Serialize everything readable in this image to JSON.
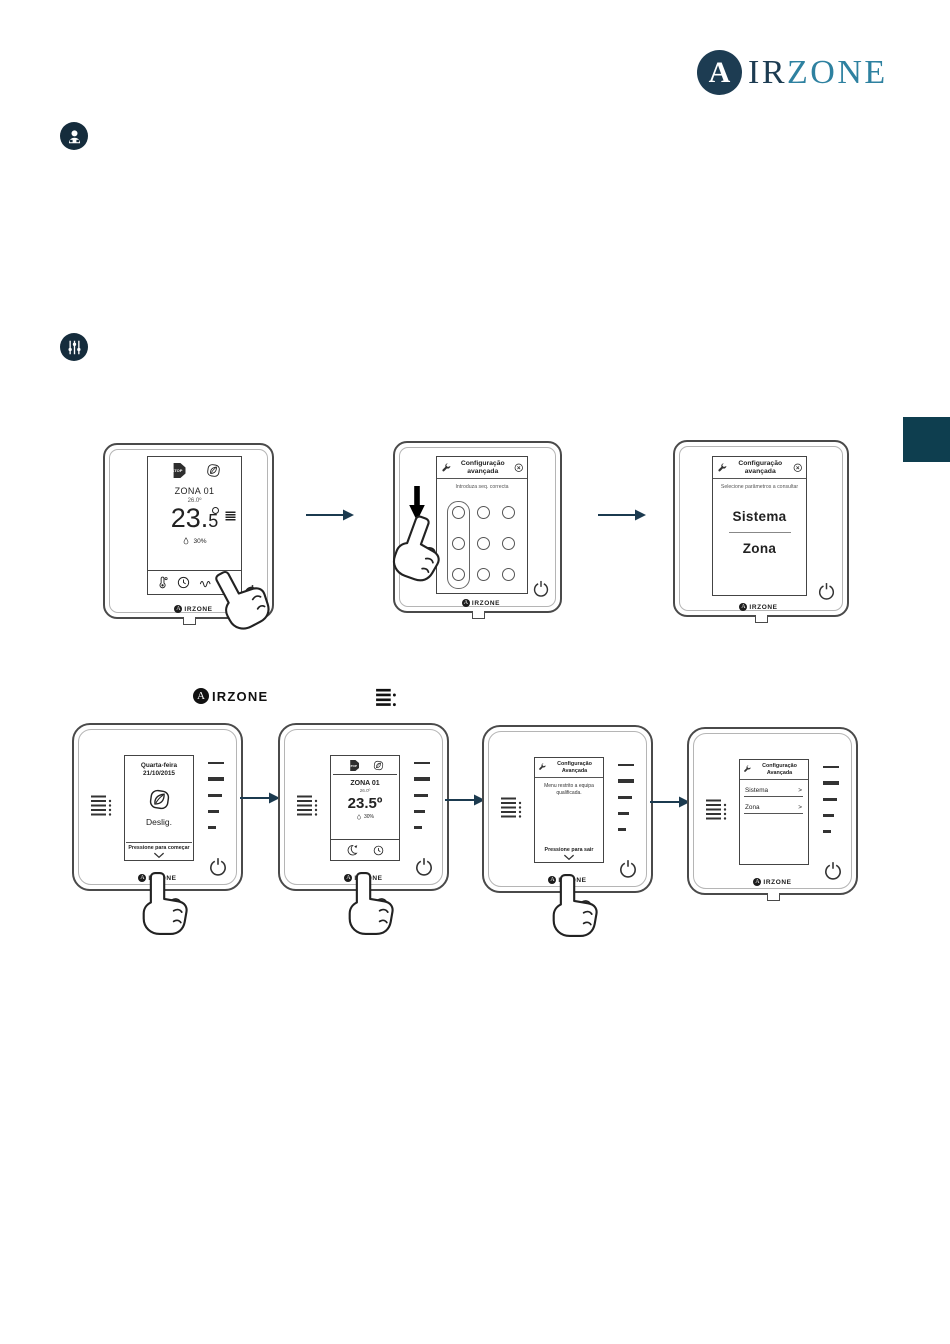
{
  "brand": {
    "a": "A",
    "ir": "IR",
    "zone": "ZONE"
  },
  "shared": {
    "logo_a": "A",
    "logo_rest": "IRZONE",
    "stop_label": "STOP",
    "chevron_right": ">"
  },
  "blueface": {
    "main": {
      "zone": "ZONA 01",
      "setpoint": "26.0º",
      "temp_int": "23.",
      "temp_dec": "5",
      "humidity": "30%"
    },
    "code": {
      "title": "Configuração avançada",
      "subtitle": "Introduza seq. correcta"
    },
    "select": {
      "title": "Configuração avançada",
      "subtitle": "Selecione parâmetros a consultar",
      "option_system": "Sistema",
      "option_zone": "Zona"
    }
  },
  "think": {
    "off": {
      "weekday": "Quarta-feira",
      "date": "21/10/2015",
      "state": "Deslig.",
      "hint": "Pressione para começar"
    },
    "main": {
      "zone": "ZONA 01",
      "setpoint": "26.0º",
      "temp": "23.5º",
      "humidity": "30%"
    },
    "restricted": {
      "title": "Configuração Avançada",
      "body": "Menu restrito a equipa qualificada.",
      "hint": "Pressione para sair"
    },
    "menu": {
      "title": "Configuração Avançada",
      "option_system": "Sistema",
      "option_zone": "Zona"
    }
  }
}
